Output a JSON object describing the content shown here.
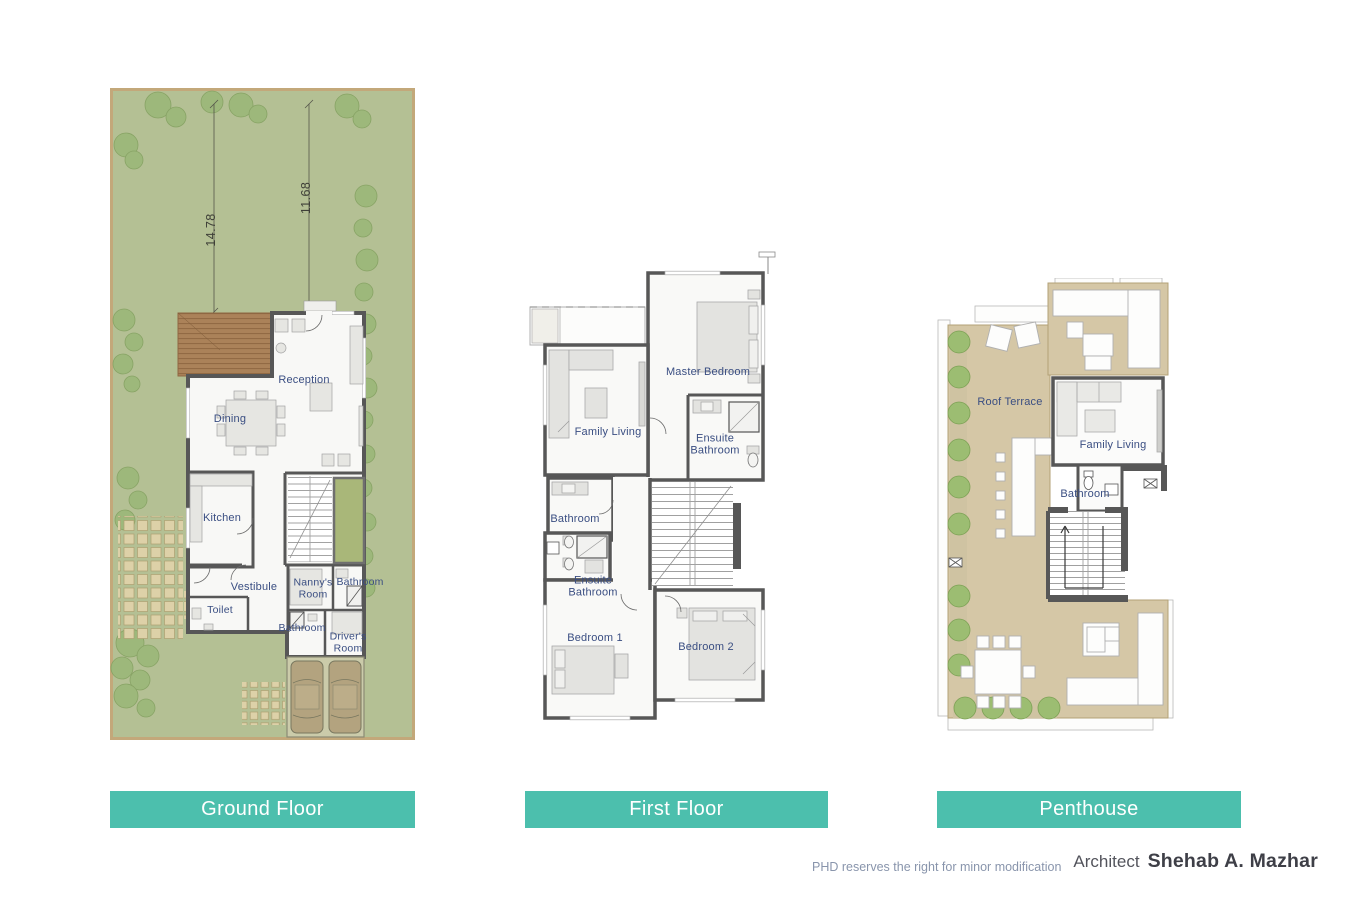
{
  "plans": {
    "ground": {
      "banner": "Ground Floor",
      "dimensions": [
        "14.78",
        "11.68"
      ],
      "rooms": {
        "reception": "Reception",
        "dining": "Dining",
        "kitchen": "Kitchen",
        "vestibule": "Vestibule",
        "toilet": "Toilet",
        "nannys_room": "Nanny's Room",
        "bathroom_a": "Bathroom",
        "bathroom_b": "Bathroom",
        "drivers_room": "Driver's Room"
      }
    },
    "first": {
      "banner": "First Floor",
      "rooms": {
        "family_living": "Family Living",
        "master_bedroom": "Master Bedroom",
        "ensuite_bathroom_a": "Ensuite Bathroom",
        "bathroom": "Bathroom",
        "ensuite_bathroom_b": "Ensuite Bathroom",
        "bedroom_1": "Bedroom 1",
        "bedroom_2": "Bedroom 2"
      }
    },
    "penthouse": {
      "banner": "Penthouse",
      "rooms": {
        "roof_terrace": "Roof Terrace",
        "family_living": "Family Living",
        "bathroom": "Bathroom"
      }
    }
  },
  "footer": {
    "disclaimer": "PHD reserves the right for minor modification",
    "architect_prefix": "Architect",
    "architect_name": "Shehab A. Mazhar"
  },
  "colors": {
    "banner_teal": "#4CBFAD",
    "room_label_blue": "#3A4E82",
    "wall_gray": "#575757",
    "garden_green": "#B4C094",
    "tree_green": "#9CB87A",
    "site_border_tan": "#C3A87A",
    "deck_brown": "#AB8259",
    "terrace_tan": "#D5C7A6",
    "paver_beige": "#DDD1A8",
    "car_tan": "#B5A480",
    "disclaimer_gray": "#8995AC",
    "architect_dark": "#3E3F47"
  }
}
